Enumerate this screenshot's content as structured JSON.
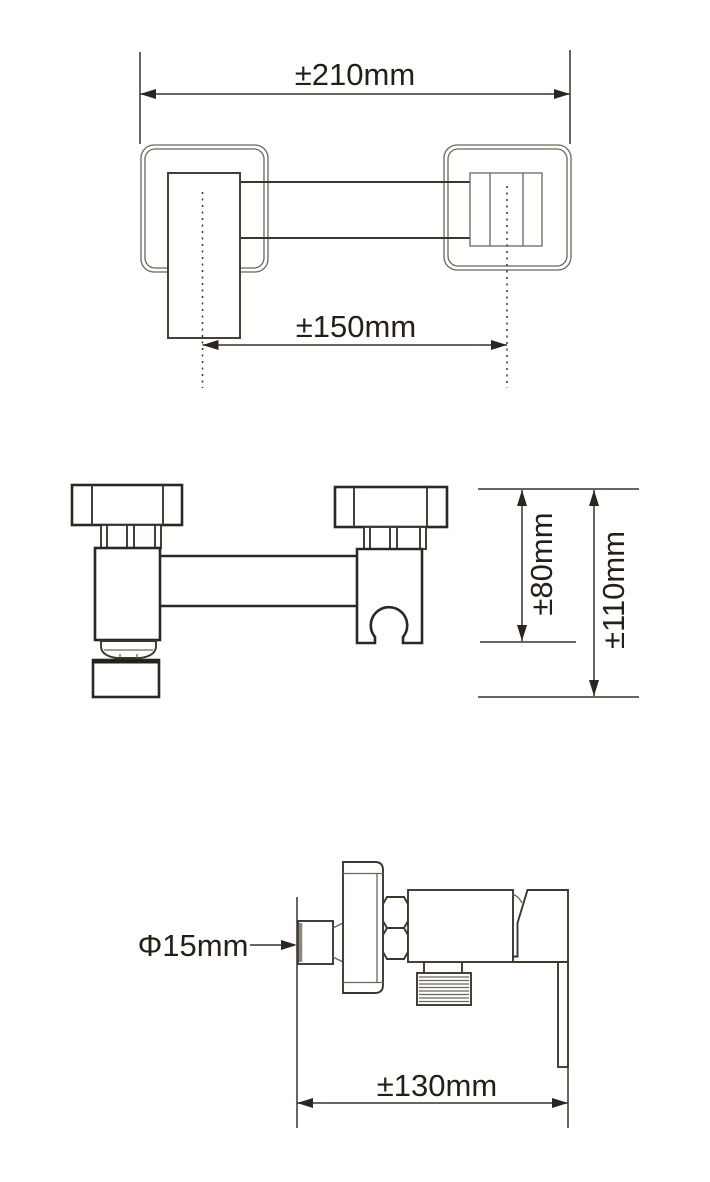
{
  "drawing": {
    "background": "#ffffff",
    "outline_color": "#2c2722",
    "thin_line_color": "#6b655c",
    "dimension_line_color": "#38322b",
    "text_color": "#251f18",
    "dimensions": {
      "overall_width": "±210mm",
      "center_distance": "±150mm",
      "holder_height": "±80mm",
      "overall_height": "±110mm",
      "outlet_diameter": "Φ15mm",
      "projection_length": "±130mm"
    }
  }
}
